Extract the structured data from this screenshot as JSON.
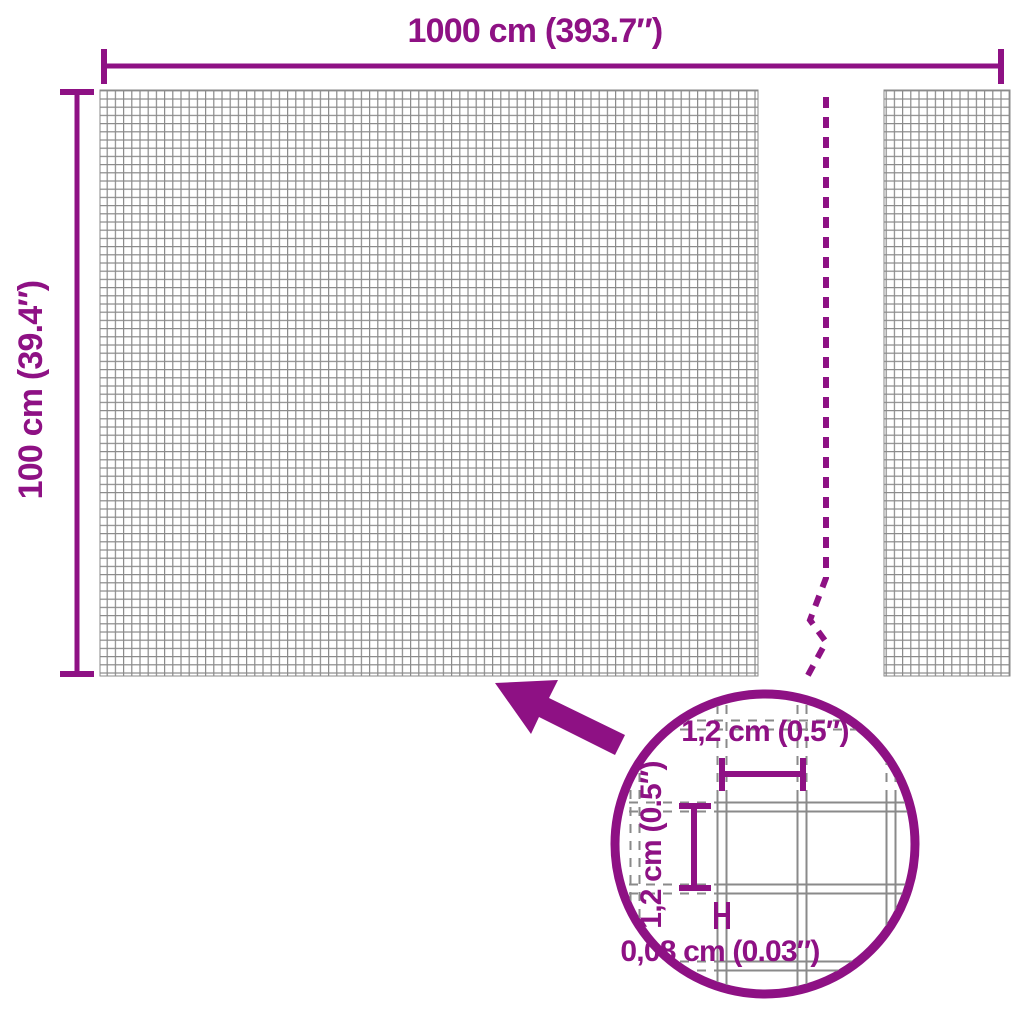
{
  "diagram": {
    "type": "product-dimension-diagram",
    "labels": {
      "width": "1000 cm (393.7″)",
      "height": "100 cm (39.4″)",
      "detail_cell_width": "1,2 cm (0.5″)",
      "detail_cell_height": "1,2 cm (0.5″)",
      "detail_wire_thickness": "0,08 cm (0.03″)"
    },
    "colors": {
      "accent": "#8E1184",
      "mesh_line": "#8A8A8A",
      "background": "#FFFFFF"
    }
  }
}
